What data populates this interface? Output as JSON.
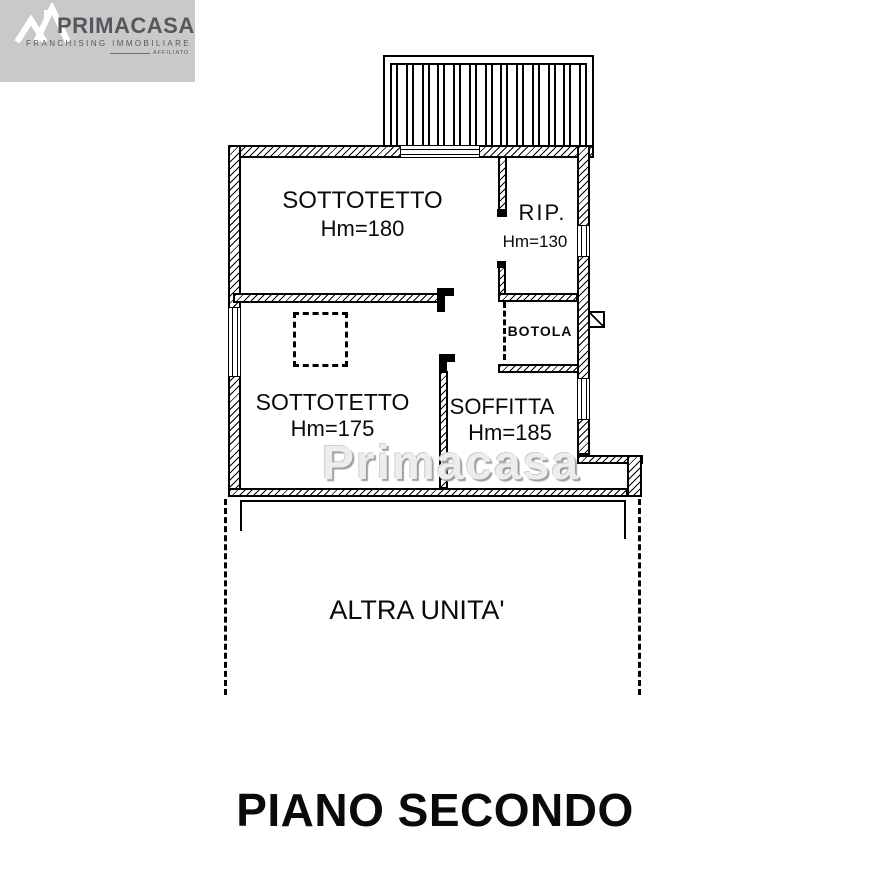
{
  "logo": {
    "brand": "PRIMACASA",
    "tagline": "FRANCHISING IMMOBILIARE",
    "affiliato": "AFFILIATO",
    "house_icon": "double-roof-house-icon",
    "bg_color": "#c9c9c9",
    "text_color": "#54585c"
  },
  "plan": {
    "room_sottotetto_1": {
      "name": "SOTTOTETTO",
      "height": "Hm=180"
    },
    "room_rip": {
      "name": "RIP.",
      "height": "Hm=130"
    },
    "room_sottotetto_2": {
      "name": "SOTTOTETTO",
      "height": "Hm=175"
    },
    "room_soffitta": {
      "name": "SOFFITTA",
      "height": "Hm=185"
    },
    "label_botola": "BOTOLA",
    "label_altra_unita": "ALTRA UNITA'",
    "watermark": "Primacasa",
    "line_color": "#000000"
  },
  "title": "PIANO SECONDO"
}
